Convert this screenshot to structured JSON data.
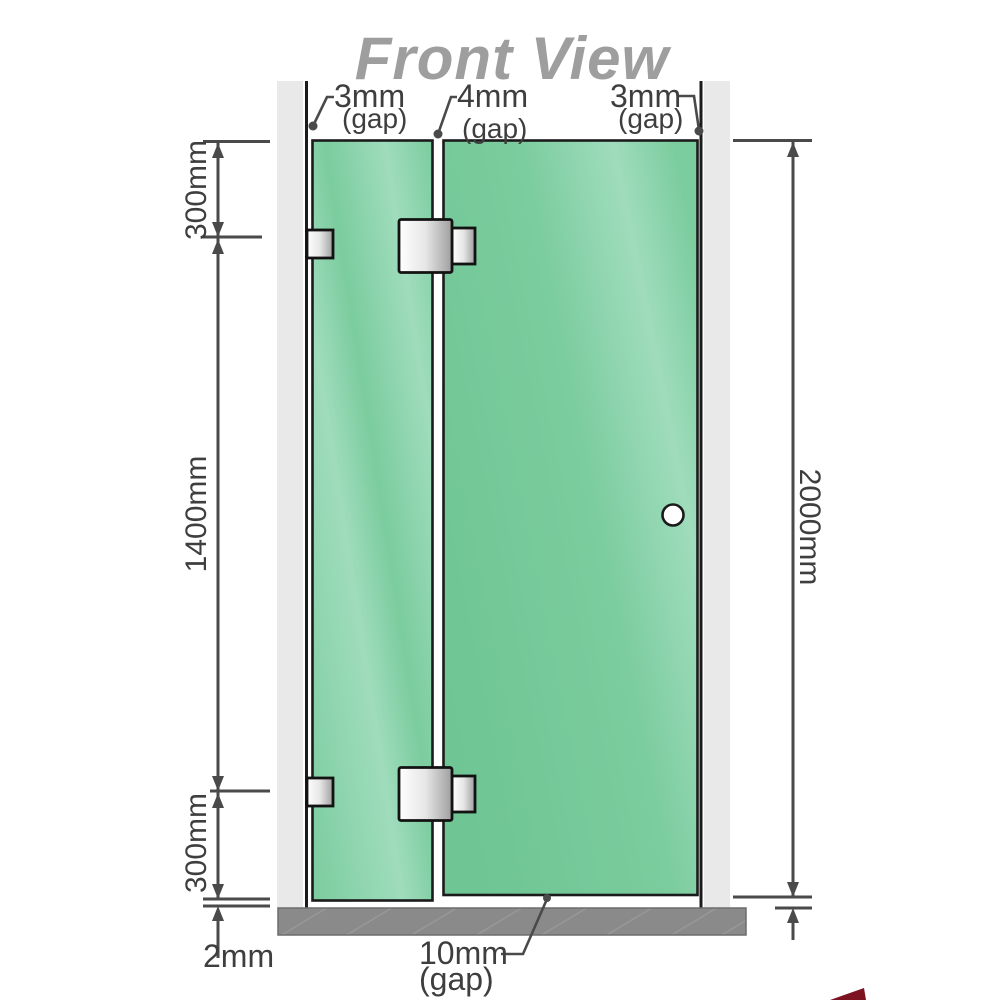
{
  "title": "Front View",
  "colors": {
    "title": "#9e9e9e",
    "wall": "#e9e9e9",
    "outline": "#1b1b1b",
    "dim": "#4a4a4a",
    "dimtext": "#3e3e3e",
    "glass": "#7bcc9e",
    "glass_light": "#9fdcbc",
    "glass_dark": "#6fc594",
    "metal_light": "#ffffff",
    "metal_mid": "#e6e6e6",
    "metal_dark": "#9f9f9f",
    "floor": "#8a8a8a",
    "floor_hatch": "#9c9c9c",
    "handle_fill": "#ffffff",
    "logo_red": "#7d1220"
  },
  "dims": {
    "gap_left": {
      "value": "3mm",
      "unit": "(gap)"
    },
    "gap_middle": {
      "value": "4mm",
      "unit": "(gap)"
    },
    "gap_right": {
      "value": "3mm",
      "unit": "(gap)"
    },
    "seg_top": "300mm",
    "seg_middle": "1400mm",
    "seg_bottom": "300mm",
    "total_height": "2000mm",
    "floor_gap_left": "2mm",
    "bottom_gap": {
      "value": "10mm",
      "unit": "(gap)"
    }
  }
}
